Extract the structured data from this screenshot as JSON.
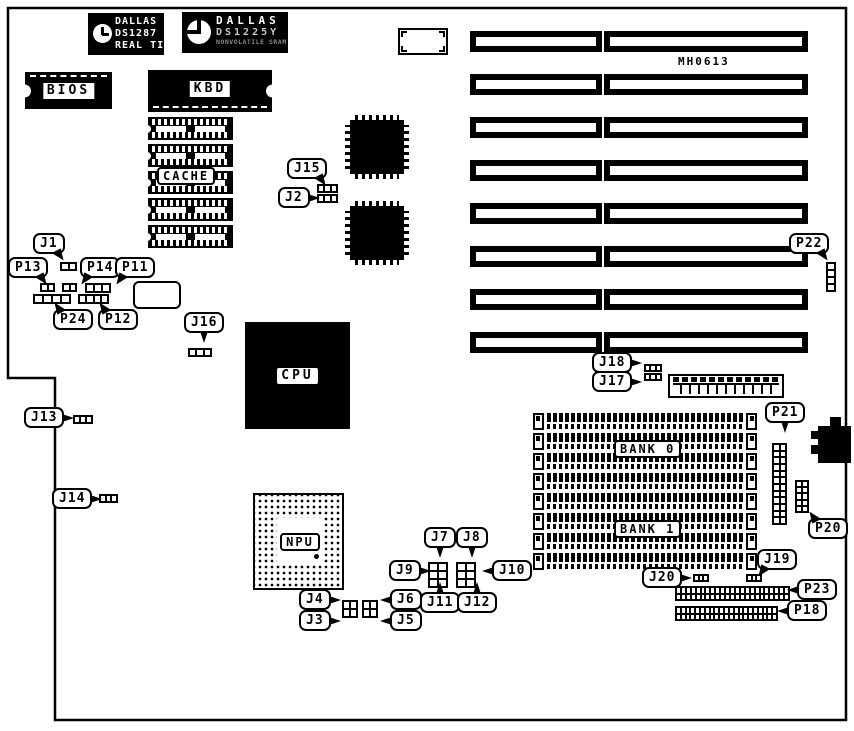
{
  "diagram": {
    "colors": {
      "ink": "#000000",
      "paper": "#ffffff"
    },
    "chips": {
      "ds1287": {
        "line1": "DALLAS",
        "line2": "DS1287",
        "line3": "REAL TIME"
      },
      "ds1225y": {
        "line1": "DALLAS",
        "line2": "DS1225Y",
        "line3": "NONVOLATILE SRAM"
      },
      "bios": "BIOS",
      "kbd": "KBD",
      "cache": "CACHE",
      "cpu": "CPU",
      "npu": "NPU",
      "bank0": "BANK 0",
      "bank1": "BANK 1",
      "board_marking": "MH0613"
    },
    "isa_slots": {
      "h": 21,
      "tops": [
        31,
        74,
        117,
        160,
        203,
        246,
        289,
        332
      ],
      "left": {
        "x": 470,
        "w": 132
      },
      "right": {
        "x": 604,
        "w": 204
      }
    },
    "cache_sockets": {
      "x": 148,
      "w": 85,
      "h": 23,
      "tops": [
        117,
        144,
        171,
        198,
        225
      ]
    },
    "simm_sockets": {
      "x": 533,
      "w": 224,
      "h": 17,
      "tops": [
        413,
        433,
        453,
        473,
        493,
        513,
        533,
        553
      ]
    },
    "headers": [
      {
        "id": "j15",
        "x": 317,
        "y": 184,
        "w": 21,
        "h": 9,
        "cols": 3,
        "rows": 1
      },
      {
        "id": "j2",
        "x": 317,
        "y": 194,
        "w": 21,
        "h": 9,
        "cols": 3,
        "rows": 1
      },
      {
        "id": "j1",
        "x": 60,
        "y": 262,
        "w": 17,
        "h": 9,
        "cols": 2,
        "rows": 1
      },
      {
        "id": "p13",
        "x": 40,
        "y": 283,
        "w": 15,
        "h": 9,
        "cols": 2,
        "rows": 1
      },
      {
        "id": "p14",
        "x": 62,
        "y": 283,
        "w": 15,
        "h": 9,
        "cols": 2,
        "rows": 1
      },
      {
        "id": "p11",
        "x": 85,
        "y": 283,
        "w": 26,
        "h": 10,
        "cols": 3,
        "rows": 1
      },
      {
        "id": "p24",
        "x": 33,
        "y": 294,
        "w": 38,
        "h": 10,
        "cols": 4,
        "rows": 1
      },
      {
        "id": "p12",
        "x": 78,
        "y": 294,
        "w": 31,
        "h": 10,
        "cols": 4,
        "rows": 1
      },
      {
        "id": "j16",
        "x": 188,
        "y": 348,
        "w": 24,
        "h": 9,
        "cols": 3,
        "rows": 1
      },
      {
        "id": "j18",
        "x": 644,
        "y": 364,
        "w": 18,
        "h": 8,
        "cols": 3,
        "rows": 1
      },
      {
        "id": "j17",
        "x": 644,
        "y": 373,
        "w": 18,
        "h": 8,
        "cols": 3,
        "rows": 1
      },
      {
        "id": "j13",
        "x": 73,
        "y": 415,
        "w": 20,
        "h": 9,
        "cols": 3,
        "rows": 1
      },
      {
        "id": "j14",
        "x": 99,
        "y": 494,
        "w": 19,
        "h": 9,
        "cols": 3,
        "rows": 1
      },
      {
        "id": "j20",
        "x": 693,
        "y": 574,
        "w": 16,
        "h": 8,
        "cols": 3,
        "rows": 1
      },
      {
        "id": "j19",
        "x": 746,
        "y": 574,
        "w": 16,
        "h": 8,
        "cols": 3,
        "rows": 1
      },
      {
        "id": "j7-j9-j11",
        "x": 428,
        "y": 562,
        "w": 20,
        "h": 26,
        "cols": 2,
        "rows": 3
      },
      {
        "id": "j8-j10-j12",
        "x": 456,
        "y": 562,
        "w": 20,
        "h": 26,
        "cols": 2,
        "rows": 3
      },
      {
        "id": "j3-j4",
        "x": 342,
        "y": 600,
        "w": 16,
        "h": 18,
        "cols": 2,
        "rows": 2
      },
      {
        "id": "j5-j6",
        "x": 362,
        "y": 600,
        "w": 16,
        "h": 18,
        "cols": 2,
        "rows": 2
      },
      {
        "id": "p22",
        "x": 826,
        "y": 262,
        "w": 10,
        "h": 30,
        "cols": 1,
        "rows": 4
      },
      {
        "id": "p21",
        "x": 772,
        "y": 443,
        "w": 15,
        "h": 82,
        "cols": 2,
        "rows": 12
      },
      {
        "id": "p20",
        "x": 795,
        "y": 480,
        "w": 14,
        "h": 33,
        "cols": 2,
        "rows": 5
      },
      {
        "id": "p23",
        "x": 675,
        "y": 586,
        "w": 115,
        "h": 15,
        "cols": 23,
        "rows": 2
      },
      {
        "id": "p18",
        "x": 675,
        "y": 606,
        "w": 103,
        "h": 15,
        "cols": 21,
        "rows": 2
      }
    ],
    "callouts": [
      {
        "id": "j1",
        "label": "J1",
        "x": 33,
        "y": 233,
        "tail": "br"
      },
      {
        "id": "p13",
        "label": "P13",
        "x": 8,
        "y": 257,
        "tail": "br"
      },
      {
        "id": "p14",
        "label": "P14",
        "x": 80,
        "y": 257,
        "tail": "bl"
      },
      {
        "id": "p11",
        "label": "P11",
        "x": 115,
        "y": 257,
        "tail": "bl"
      },
      {
        "id": "p24",
        "label": "P24",
        "x": 53,
        "y": 309,
        "tail": "tl"
      },
      {
        "id": "p12",
        "label": "P12",
        "x": 98,
        "y": 309,
        "tail": "tl"
      },
      {
        "id": "j15",
        "label": "J15",
        "x": 287,
        "y": 158,
        "tail": "br"
      },
      {
        "id": "j2",
        "label": "J2",
        "x": 278,
        "y": 187,
        "tail": "r"
      },
      {
        "id": "j16",
        "label": "J16",
        "x": 184,
        "y": 312,
        "tail": "b"
      },
      {
        "id": "j13",
        "label": "J13",
        "x": 24,
        "y": 407,
        "tail": "r"
      },
      {
        "id": "j14",
        "label": "J14",
        "x": 52,
        "y": 488,
        "tail": "r"
      },
      {
        "id": "p22",
        "label": "P22",
        "x": 789,
        "y": 233,
        "tail": "br"
      },
      {
        "id": "j18",
        "label": "J18",
        "x": 592,
        "y": 352,
        "tail": "r"
      },
      {
        "id": "j17",
        "label": "J17",
        "x": 592,
        "y": 371,
        "tail": "r"
      },
      {
        "id": "p21",
        "label": "P21",
        "x": 765,
        "y": 402,
        "tail": "b"
      },
      {
        "id": "p20",
        "label": "P20",
        "x": 808,
        "y": 518,
        "tail": "tl"
      },
      {
        "id": "j7",
        "label": "J7",
        "x": 424,
        "y": 527,
        "tail": "b"
      },
      {
        "id": "j8",
        "label": "J8",
        "x": 456,
        "y": 527,
        "tail": "b"
      },
      {
        "id": "j9",
        "label": "J9",
        "x": 389,
        "y": 560,
        "tail": "r"
      },
      {
        "id": "j10",
        "label": "J10",
        "x": 492,
        "y": 560,
        "tail": "l"
      },
      {
        "id": "j11",
        "label": "J11",
        "x": 420,
        "y": 592,
        "tail": "t"
      },
      {
        "id": "j12",
        "label": "J12",
        "x": 457,
        "y": 592,
        "tail": "t"
      },
      {
        "id": "j4",
        "label": "J4",
        "x": 299,
        "y": 589,
        "tail": "r"
      },
      {
        "id": "j3",
        "label": "J3",
        "x": 299,
        "y": 610,
        "tail": "r"
      },
      {
        "id": "j6",
        "label": "J6",
        "x": 390,
        "y": 589,
        "tail": "l"
      },
      {
        "id": "j5",
        "label": "J5",
        "x": 390,
        "y": 610,
        "tail": "l"
      },
      {
        "id": "j20",
        "label": "J20",
        "x": 642,
        "y": 567,
        "tail": "r"
      },
      {
        "id": "j19",
        "label": "J19",
        "x": 757,
        "y": 549,
        "tail": "bl"
      },
      {
        "id": "p23",
        "label": "P23",
        "x": 797,
        "y": 579,
        "tail": "l"
      },
      {
        "id": "p18",
        "label": "P18",
        "x": 787,
        "y": 600,
        "tail": "l"
      }
    ]
  }
}
